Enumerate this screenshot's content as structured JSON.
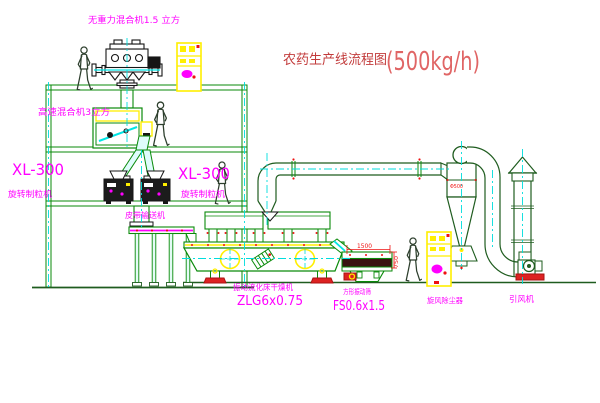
{
  "title": {
    "name": "农药生产线流程图",
    "capacity": "(500kg/h)"
  },
  "labels": {
    "gravity_mixer": "无重力混合机1.5 立方",
    "high_speed_mixer": "高速混合机3立方",
    "granulator_left_model": "XL-300",
    "granulator_left_name": "旋转制粒机",
    "granulator_mid_model": "XL-300",
    "granulator_mid_name": "旋转制粒机",
    "belt_conveyor": "皮带输送机",
    "dryer_name": "振动流化床干燥机",
    "dryer_model": "ZLG6x0.75",
    "sieve_name": "方形振动筛",
    "sieve_model": "FS0.6x1.5",
    "cyclone_name": "旋风除尘器",
    "cyclone_size": "Φ500",
    "fan_name": "引风机"
  },
  "dimensions": {
    "sieve_width_mm": "1500",
    "sieve_height_mm": "750"
  },
  "colors": {
    "background": "#ffffff",
    "structure_green": "#0a8a0a",
    "duct_dark_green": "#1f5c1f",
    "equipment_dark": "#161616",
    "label_magenta": "#ff00ff",
    "title_red": "#c23b3b",
    "capacity_red": "#e06565",
    "centerline_cyan": "#00dddd",
    "cabinet_yellow": "#ffef00",
    "accent_red": "#ee1111"
  }
}
